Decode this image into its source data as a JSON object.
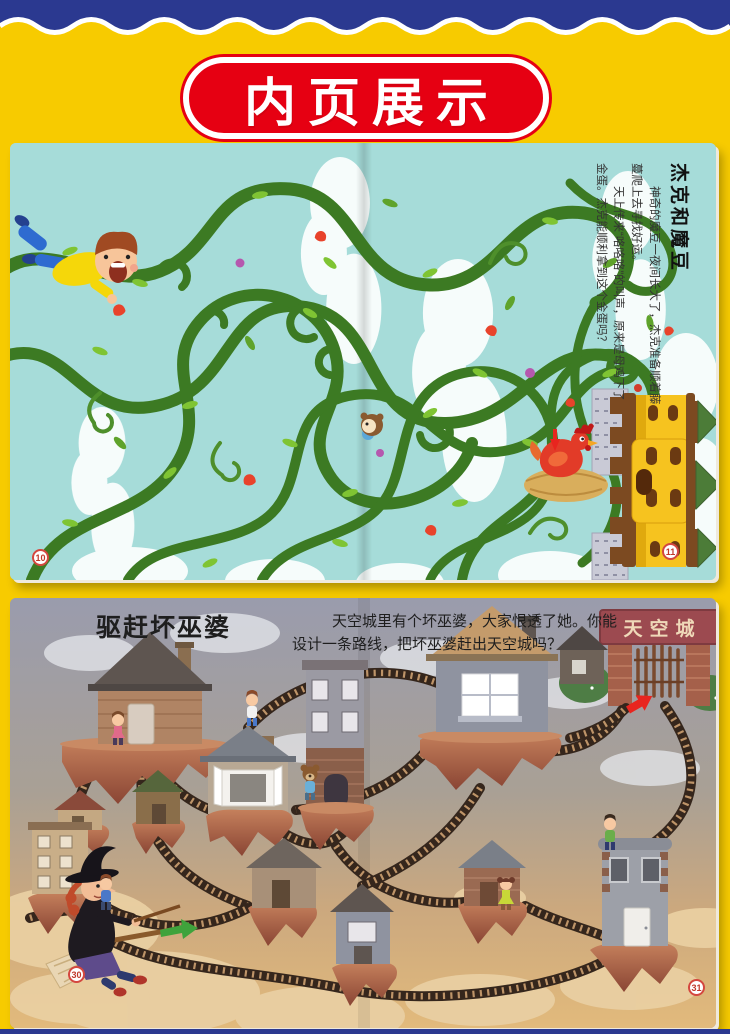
{
  "banner": {
    "label": "内页展示"
  },
  "pages": {
    "beanstalk": {
      "title": "杰克和魔豆",
      "paragraphs": [
        "神奇的魔豆一夜间长大了，杰克准备顺着藤蔓爬上去寻找好运。",
        "天上传来“咯咯咯”的叫声，原来是母鸡下了金蛋。杰克能顺利拿到这个金蛋吗？"
      ],
      "page_left": "10",
      "page_right": "11"
    },
    "skycity": {
      "title": "驱赶坏巫婆",
      "description_lines": [
        "天空城里有个坏巫婆，大家恨透了她。你能",
        "设计一条路线，把坏巫婆赶出天空城吗？"
      ],
      "gate_sign": "天空城",
      "page_left": "30",
      "page_right": "31"
    }
  },
  "colors": {
    "background": "#F7CB00",
    "band_navy": "#2B3990",
    "banner_red": "#E60012",
    "page1_sky": "#A6DCD9",
    "vine_green": "#3C7A23",
    "page2_sky_top": "#9A9CAD",
    "page2_sand": "#E2BA7C",
    "island_rock": "#A85A40",
    "track_brown": "#35261C",
    "gate_sign_red": "#9C4A50"
  }
}
